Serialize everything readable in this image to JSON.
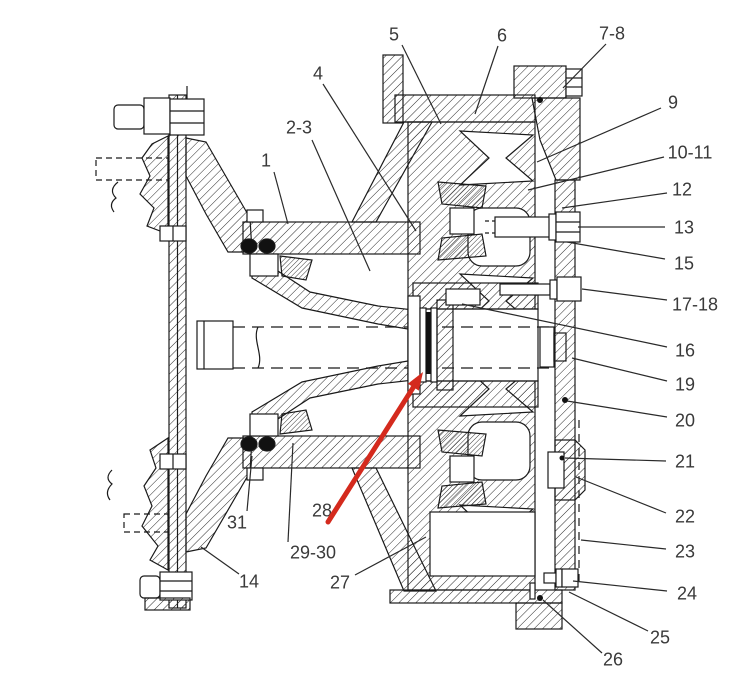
{
  "figure": {
    "kind": "sectional-parts-diagram",
    "background": "#ffffff",
    "line_color": "#1a1a1a",
    "leader_color": "#2a2a2a",
    "label_color": "#3a3a3a",
    "label_font_size": 18
  },
  "highlight_arrow": {
    "color": "#d42a1d",
    "width": 5,
    "x1": 328,
    "y1": 522,
    "x2": 423,
    "y2": 372
  },
  "callouts": [
    {
      "label": "1",
      "tx": 266,
      "ty": 160,
      "lx1": 274,
      "ly1": 172,
      "lx2": 288,
      "ly2": 224
    },
    {
      "label": "2-3",
      "tx": 299,
      "ty": 127,
      "lx1": 312,
      "ly1": 140,
      "lx2": 370,
      "ly2": 271
    },
    {
      "label": "4",
      "tx": 318,
      "ty": 73,
      "lx1": 323,
      "ly1": 84,
      "lx2": 416,
      "ly2": 231
    },
    {
      "label": "5",
      "tx": 394,
      "ty": 34,
      "lx1": 402,
      "ly1": 45,
      "lx2": 441,
      "ly2": 124
    },
    {
      "label": "6",
      "tx": 502,
      "ty": 35,
      "lx1": 498,
      "ly1": 46,
      "lx2": 475,
      "ly2": 114
    },
    {
      "label": "7-8",
      "tx": 612,
      "ty": 33,
      "lx1": 606,
      "ly1": 44,
      "lx2": 563,
      "ly2": 88
    },
    {
      "label": "9",
      "tx": 673,
      "ty": 102,
      "lx1": 661,
      "ly1": 108,
      "lx2": 537,
      "ly2": 162
    },
    {
      "label": "10-11",
      "tx": 690,
      "ty": 152,
      "lx1": 664,
      "ly1": 157,
      "lx2": 528,
      "ly2": 190
    },
    {
      "label": "12",
      "tx": 682,
      "ty": 189,
      "lx1": 667,
      "ly1": 193,
      "lx2": 562,
      "ly2": 208
    },
    {
      "label": "13",
      "tx": 684,
      "ty": 227,
      "lx1": 665,
      "ly1": 227,
      "lx2": 578,
      "ly2": 227
    },
    {
      "label": "15",
      "tx": 684,
      "ty": 263,
      "lx1": 665,
      "ly1": 259,
      "lx2": 567,
      "ly2": 242
    },
    {
      "label": "17-18",
      "tx": 695,
      "ty": 304,
      "lx1": 667,
      "ly1": 300,
      "lx2": 582,
      "ly2": 289
    },
    {
      "label": "16",
      "tx": 685,
      "ty": 350,
      "lx1": 667,
      "ly1": 347,
      "lx2": 462,
      "ly2": 304
    },
    {
      "label": "19",
      "tx": 685,
      "ty": 384,
      "lx1": 667,
      "ly1": 381,
      "lx2": 572,
      "ly2": 358
    },
    {
      "label": "20",
      "tx": 685,
      "ty": 420,
      "lx1": 667,
      "ly1": 417,
      "lx2": 567,
      "ly2": 401
    },
    {
      "label": "21",
      "tx": 685,
      "ty": 461,
      "lx1": 666,
      "ly1": 461,
      "lx2": 565,
      "ly2": 458
    },
    {
      "label": "22",
      "tx": 685,
      "ty": 516,
      "lx1": 666,
      "ly1": 513,
      "lx2": 576,
      "ly2": 477
    },
    {
      "label": "23",
      "tx": 685,
      "ty": 551,
      "lx1": 666,
      "ly1": 549,
      "lx2": 581,
      "ly2": 540
    },
    {
      "label": "24",
      "tx": 687,
      "ty": 593,
      "lx1": 667,
      "ly1": 591,
      "lx2": 573,
      "ly2": 581
    },
    {
      "label": "25",
      "tx": 660,
      "ty": 637,
      "lx1": 648,
      "ly1": 631,
      "lx2": 569,
      "ly2": 592
    },
    {
      "label": "26",
      "tx": 613,
      "ty": 659,
      "lx1": 602,
      "ly1": 653,
      "lx2": 543,
      "ly2": 600
    },
    {
      "label": "27",
      "tx": 340,
      "ty": 582,
      "lx1": 355,
      "ly1": 575,
      "lx2": 426,
      "ly2": 537
    },
    {
      "label": "29-30",
      "tx": 313,
      "ty": 552,
      "lx1": 288,
      "ly1": 542,
      "lx2": 293,
      "ly2": 443
    },
    {
      "label": "28",
      "tx": 322,
      "ty": 510
    },
    {
      "label": "31",
      "tx": 237,
      "ty": 522,
      "lx1": 247,
      "ly1": 511,
      "lx2": 252,
      "ly2": 456
    },
    {
      "label": "14",
      "tx": 249,
      "ty": 581,
      "lx1": 239,
      "ly1": 574,
      "lx2": 201,
      "ly2": 547
    }
  ]
}
